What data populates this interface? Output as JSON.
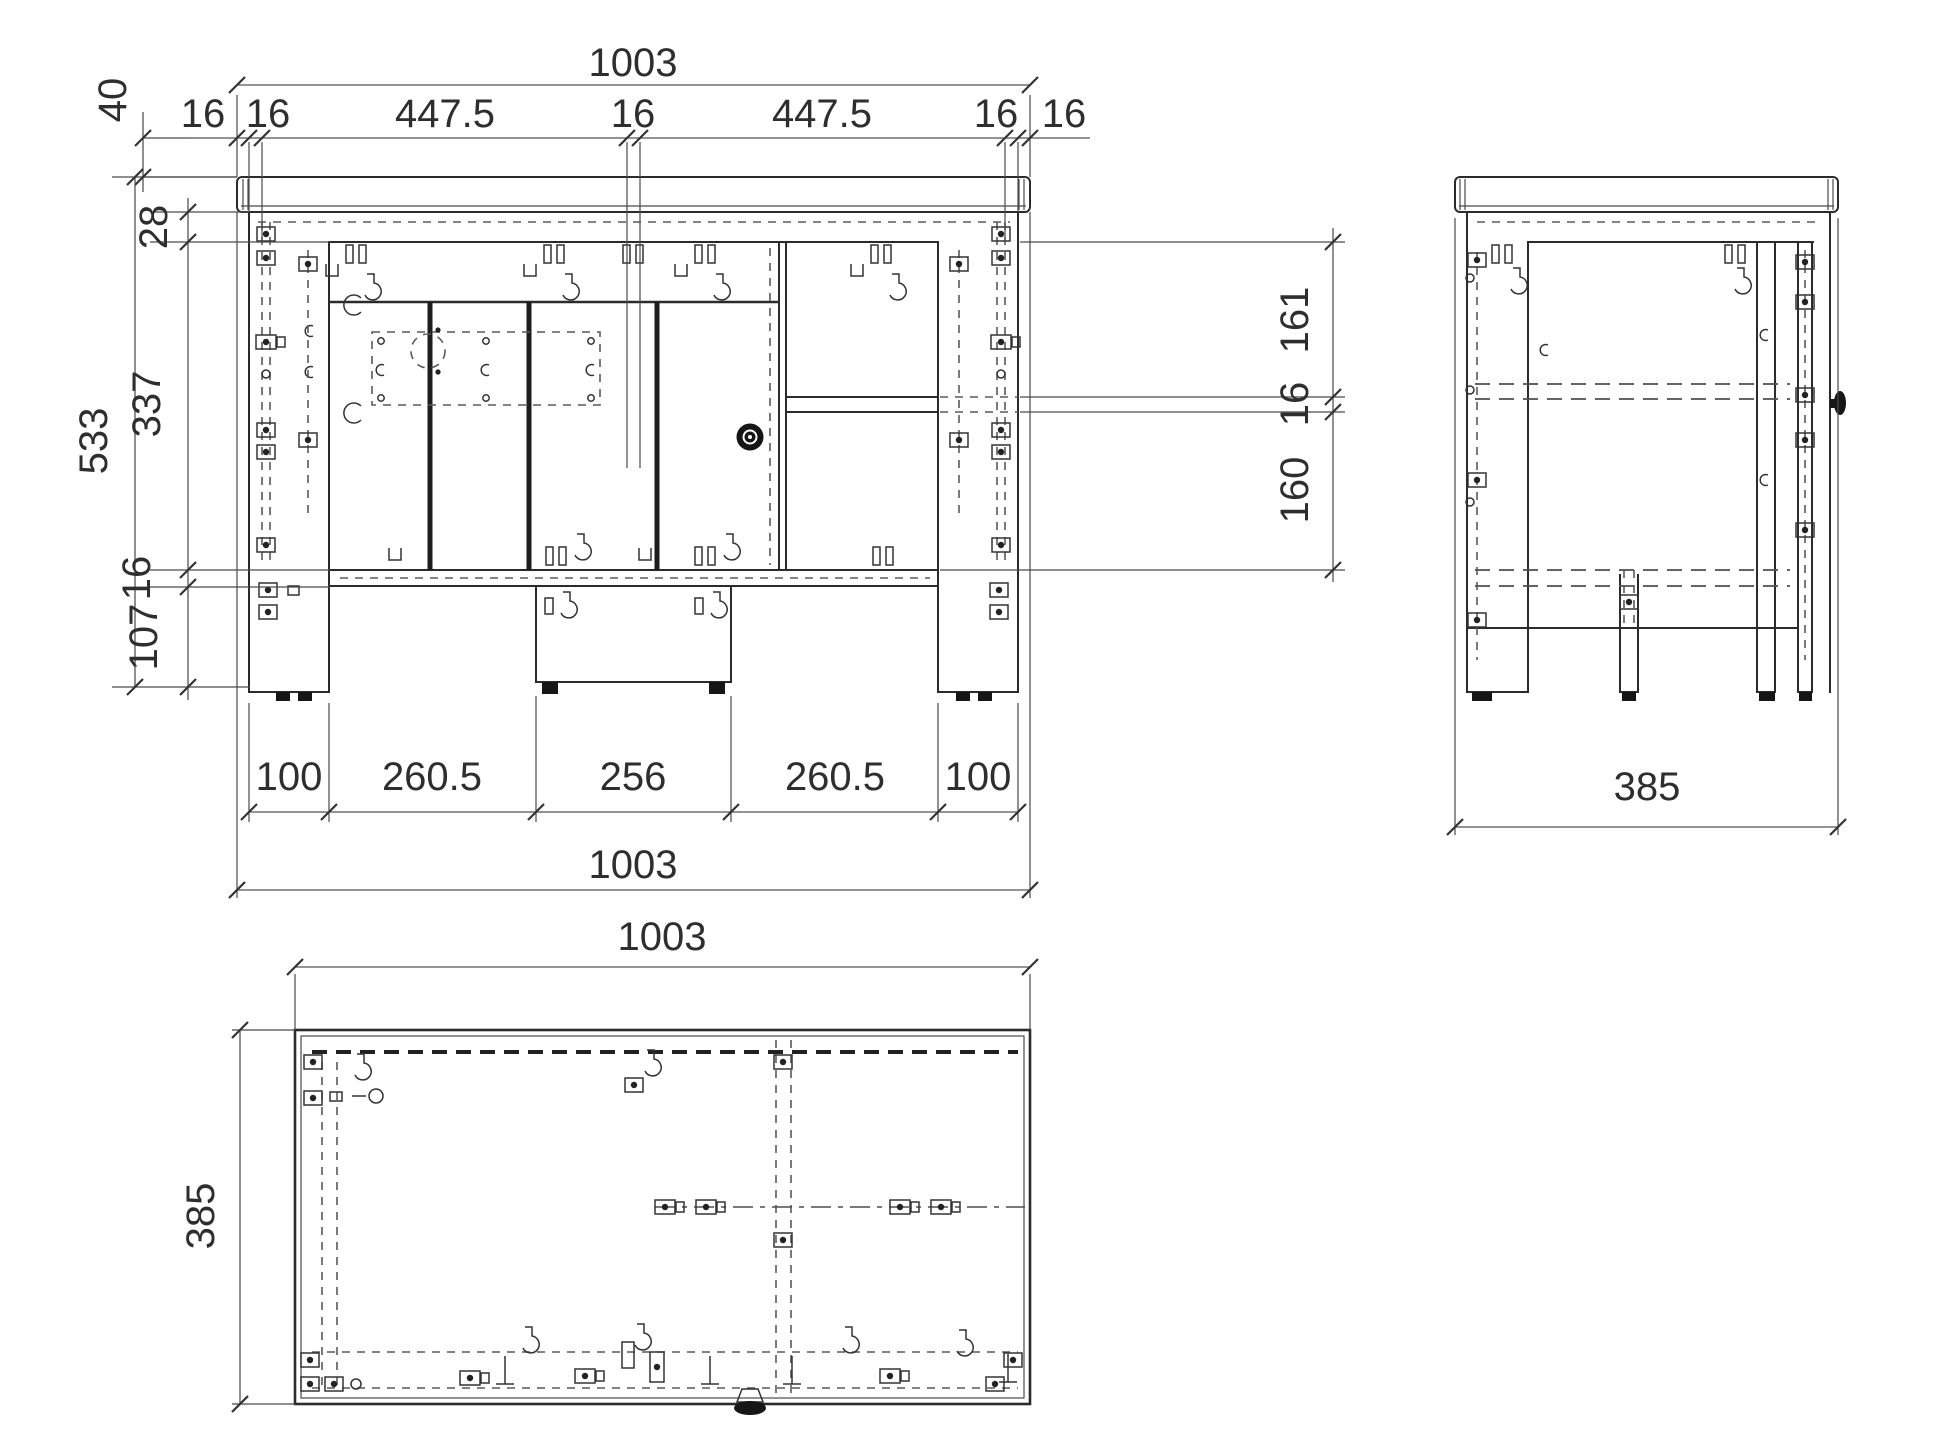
{
  "drawing": {
    "type": "furniture cabinet orthographic technical drawing",
    "units_shown": "mm",
    "views": {
      "front": {
        "dims": {
          "overall_width_top": "1003",
          "overall_width_bottom": "1003",
          "chain_top": [
            "16",
            "16",
            "447.5",
            "16",
            "447.5",
            "16",
            "16"
          ],
          "chain_bottom": [
            "100",
            "260.5",
            "256",
            "260.5",
            "100"
          ],
          "top_panel_height": "40",
          "rail_height": "28",
          "interior_height": "337",
          "overall_height": "533",
          "bottom_panel": "16",
          "plinth_height": "107",
          "right_upper_opening": "161",
          "shelf_thickness": "16",
          "right_lower_opening": "160"
        }
      },
      "side": {
        "dims": {
          "overall_depth": "385"
        }
      },
      "plan": {
        "dims": {
          "overall_width": "1003",
          "overall_depth": "385"
        }
      }
    },
    "colors": {
      "background": "#ffffff",
      "line": "#2b2b2b",
      "dimension_text": "#2e2e2e"
    }
  }
}
